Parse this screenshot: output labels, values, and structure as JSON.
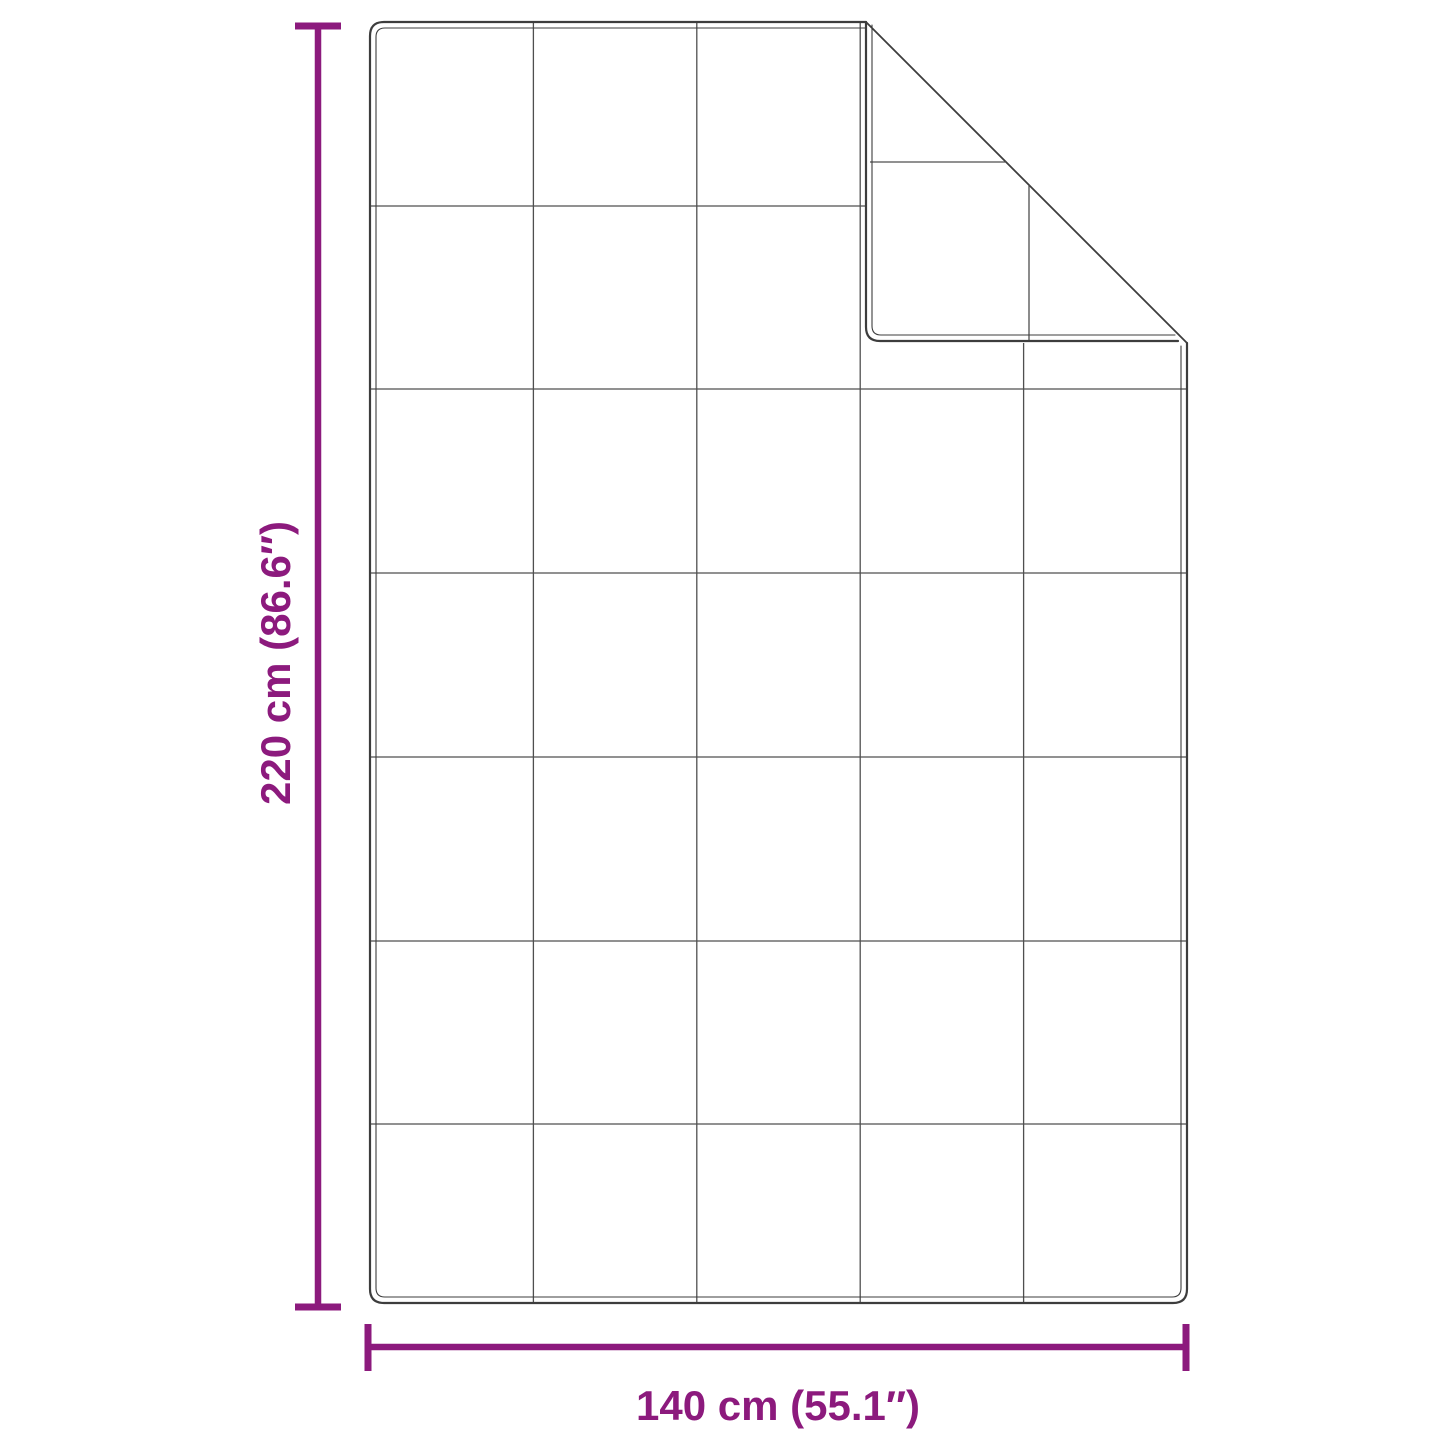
{
  "diagram": {
    "type": "product-dimension-diagram",
    "subject": "quilted weighted blanket with folded top-right corner",
    "dimensions": {
      "height_label": "220 cm (86.6″)",
      "width_label": "140 cm (55.1″)"
    },
    "grid": {
      "columns": 5,
      "rows": 7
    },
    "colors": {
      "dimension_accent": "#8C1A7D",
      "outline": "#3d3d3d",
      "grid": "#4f4f4f",
      "background": "#ffffff"
    }
  }
}
